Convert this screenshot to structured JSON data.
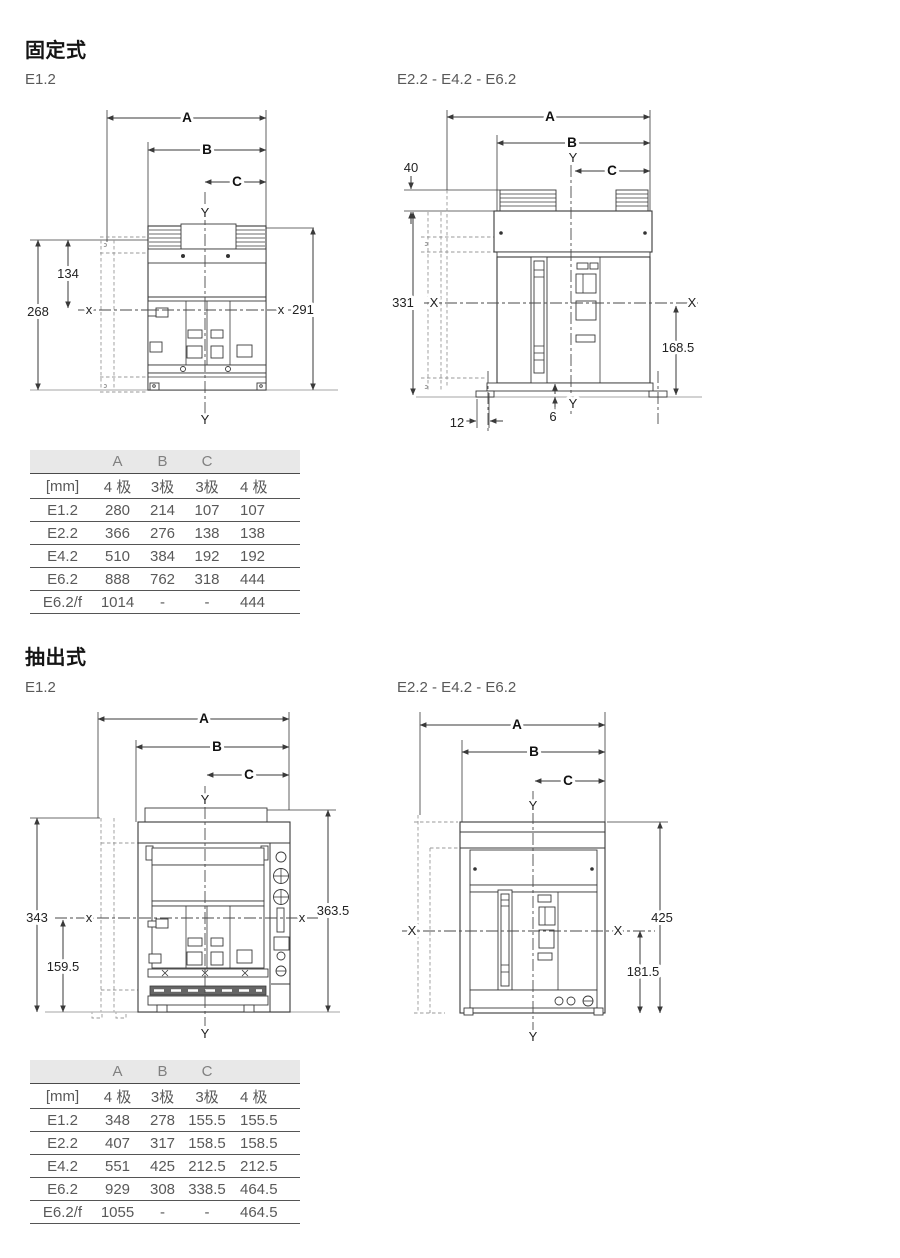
{
  "sections": {
    "fixed": {
      "heading": "固定式",
      "left_label": "E1.2",
      "right_label": "E2.2 - E4.2 - E6.2"
    },
    "withdrawable": {
      "heading": "抽出式",
      "left_label": "E1.2",
      "right_label": "E2.2 - E4.2 - E6.2"
    }
  },
  "drawings": {
    "fixed_e12": {
      "dim_a": "A",
      "dim_b": "B",
      "dim_c": "C",
      "y_top": "Y",
      "y_bottom": "Y",
      "x_left": "x",
      "x_right": "x",
      "total_height": "268",
      "upper_height": "134",
      "right_height": "291"
    },
    "fixed_e2246": {
      "dim_a": "A",
      "dim_b": "B",
      "dim_c": "C",
      "y_top": "Y",
      "y_bottom": "Y",
      "x_left": "X",
      "x_right": "X",
      "terminal_height": "40",
      "total_height": "331",
      "lower_right_height": "168.5",
      "base_gap": "6",
      "foot_offset": "12"
    },
    "draw_e12": {
      "dim_a": "A",
      "dim_b": "B",
      "dim_c": "C",
      "y_top": "Y",
      "y_bottom": "Y",
      "x_left": "x",
      "x_right": "x",
      "total_height": "343",
      "lower_height": "159.5",
      "right_height": "363.5"
    },
    "draw_e2246": {
      "dim_a": "A",
      "dim_b": "B",
      "dim_c": "C",
      "y_top": "Y",
      "y_bottom": "Y",
      "x_left": "X",
      "x_right": "X",
      "right_height": "425",
      "lower_right_height": "181.5"
    }
  },
  "tables": {
    "fixed": {
      "unit_label": "[mm]",
      "group_headers": [
        "A",
        "B",
        "C"
      ],
      "pole_headers": [
        "4 极",
        "3极",
        "3极",
        "4 极"
      ],
      "rows": [
        {
          "label": "E1.2",
          "values": [
            "280",
            "214",
            "107",
            "107"
          ]
        },
        {
          "label": "E2.2",
          "values": [
            "366",
            "276",
            "138",
            "138"
          ]
        },
        {
          "label": "E4.2",
          "values": [
            "510",
            "384",
            "192",
            "192"
          ]
        },
        {
          "label": "E6.2",
          "values": [
            "888",
            "762",
            "318",
            "444"
          ]
        },
        {
          "label": "E6.2/f",
          "values": [
            "1014",
            "-",
            "-",
            "444"
          ]
        }
      ]
    },
    "withdrawable": {
      "unit_label": "[mm]",
      "group_headers": [
        "A",
        "B",
        "C"
      ],
      "pole_headers": [
        "4 极",
        "3极",
        "3极",
        "4 极"
      ],
      "rows": [
        {
          "label": "E1.2",
          "values": [
            "348",
            "278",
            "155.5",
            "155.5"
          ]
        },
        {
          "label": "E2.2",
          "values": [
            "407",
            "317",
            "158.5",
            "158.5"
          ]
        },
        {
          "label": "E4.2",
          "values": [
            "551",
            "425",
            "212.5",
            "212.5"
          ]
        },
        {
          "label": "E6.2",
          "values": [
            "929",
            "308",
            "338.5",
            "464.5"
          ]
        },
        {
          "label": "E6.2/f",
          "values": [
            "1055",
            "-",
            "-",
            "464.5"
          ]
        }
      ]
    }
  }
}
